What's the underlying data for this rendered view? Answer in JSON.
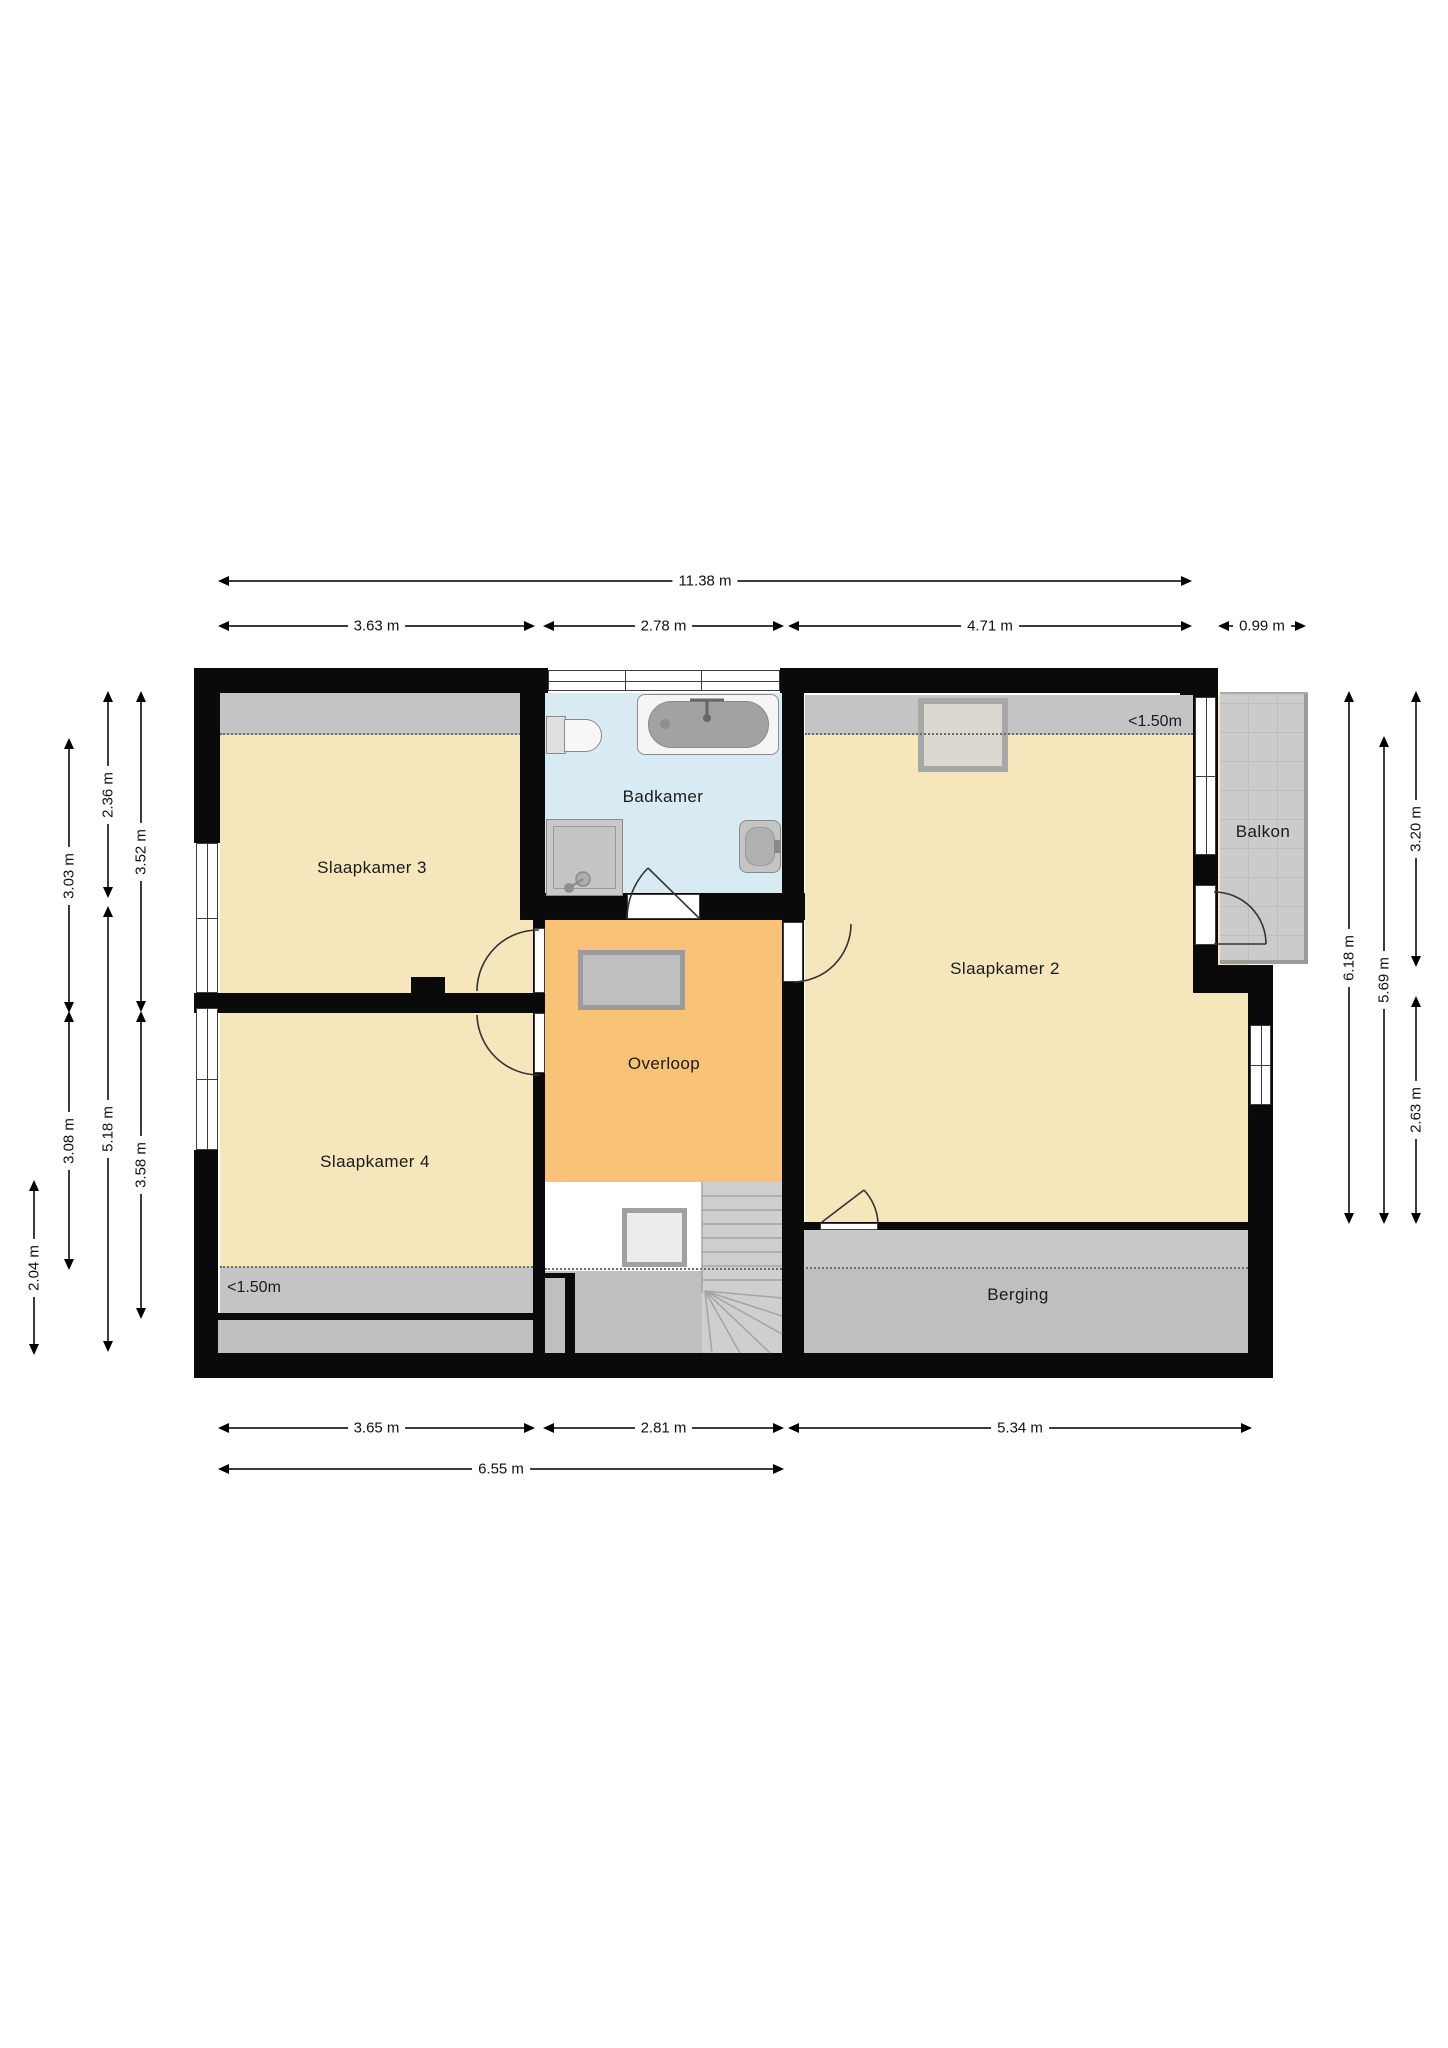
{
  "colors": {
    "wall": "#0a0a0a",
    "room_yellow": "#f5e6bb",
    "landing_orange": "#f8c377",
    "bathroom_blue": "#d9ebf2",
    "low_ceiling_gray": "#c4c4c4",
    "storage_gray_light": "#c9c9c9",
    "storage_gray_dark": "#bfbfbf",
    "balcony_tile": "#cbcbcb",
    "stairs_gray": "#cfcfcf",
    "dim_line": "#3c3c3c"
  },
  "rooms": [
    {
      "id": "slaapkamer3",
      "label": "Slaapkamer 3",
      "x": 372,
      "y": 868
    },
    {
      "id": "slaapkamer4",
      "label": "Slaapkamer 4",
      "x": 375,
      "y": 1162
    },
    {
      "id": "badkamer",
      "label": "Badkamer",
      "x": 663,
      "y": 797
    },
    {
      "id": "overloop",
      "label": "Overloop",
      "x": 664,
      "y": 1064
    },
    {
      "id": "slaapkamer2",
      "label": "Slaapkamer 2",
      "x": 1005,
      "y": 969
    },
    {
      "id": "berging",
      "label": "Berging",
      "x": 1018,
      "y": 1295
    },
    {
      "id": "balkon",
      "label": "Balkon",
      "x": 1263,
      "y": 832
    }
  ],
  "annotations": [
    {
      "id": "low-ceiling-slaapkamer2",
      "label": "<1.50m",
      "x": 1155,
      "y": 722
    },
    {
      "id": "low-ceiling-slaapkamer4",
      "label": "<1.50m",
      "x": 254,
      "y": 1288
    }
  ],
  "dimensions": {
    "horizontal": [
      {
        "label": "11.38 m",
        "x1": 220,
        "x2": 1190,
        "y": 580
      },
      {
        "label": "3.63 m",
        "x1": 220,
        "x2": 533,
        "y": 625
      },
      {
        "label": "2.78 m",
        "x1": 545,
        "x2": 782,
        "y": 625
      },
      {
        "label": "4.71 m",
        "x1": 790,
        "x2": 1190,
        "y": 625
      },
      {
        "label": "0.99 m",
        "x1": 1220,
        "x2": 1304,
        "y": 625
      },
      {
        "label": "3.65 m",
        "x1": 220,
        "x2": 533,
        "y": 1427
      },
      {
        "label": "2.81 m",
        "x1": 545,
        "x2": 782,
        "y": 1427
      },
      {
        "label": "5.34 m",
        "x1": 790,
        "x2": 1250,
        "y": 1427
      },
      {
        "label": "6.55 m",
        "x1": 220,
        "x2": 782,
        "y": 1468
      }
    ],
    "vertical": [
      {
        "label": "2.36 m",
        "x": 107,
        "y1": 693,
        "y2": 896
      },
      {
        "label": "5.18 m",
        "x": 107,
        "y1": 908,
        "y2": 1350
      },
      {
        "label": "3.03 m",
        "x": 68,
        "y1": 740,
        "y2": 1011
      },
      {
        "label": "3.08 m",
        "x": 68,
        "y1": 1013,
        "y2": 1268
      },
      {
        "label": "3.52 m",
        "x": 140,
        "y1": 693,
        "y2": 1010
      },
      {
        "label": "3.58 m",
        "x": 140,
        "y1": 1013,
        "y2": 1317
      },
      {
        "label": "2.04 m",
        "x": 33,
        "y1": 1182,
        "y2": 1353
      },
      {
        "label": "6.18 m",
        "x": 1348,
        "y1": 693,
        "y2": 1222
      },
      {
        "label": "5.69 m",
        "x": 1383,
        "y1": 738,
        "y2": 1222
      },
      {
        "label": "3.20 m",
        "x": 1415,
        "y1": 693,
        "y2": 965
      },
      {
        "label": "2.63 m",
        "x": 1415,
        "y1": 998,
        "y2": 1222
      }
    ]
  }
}
